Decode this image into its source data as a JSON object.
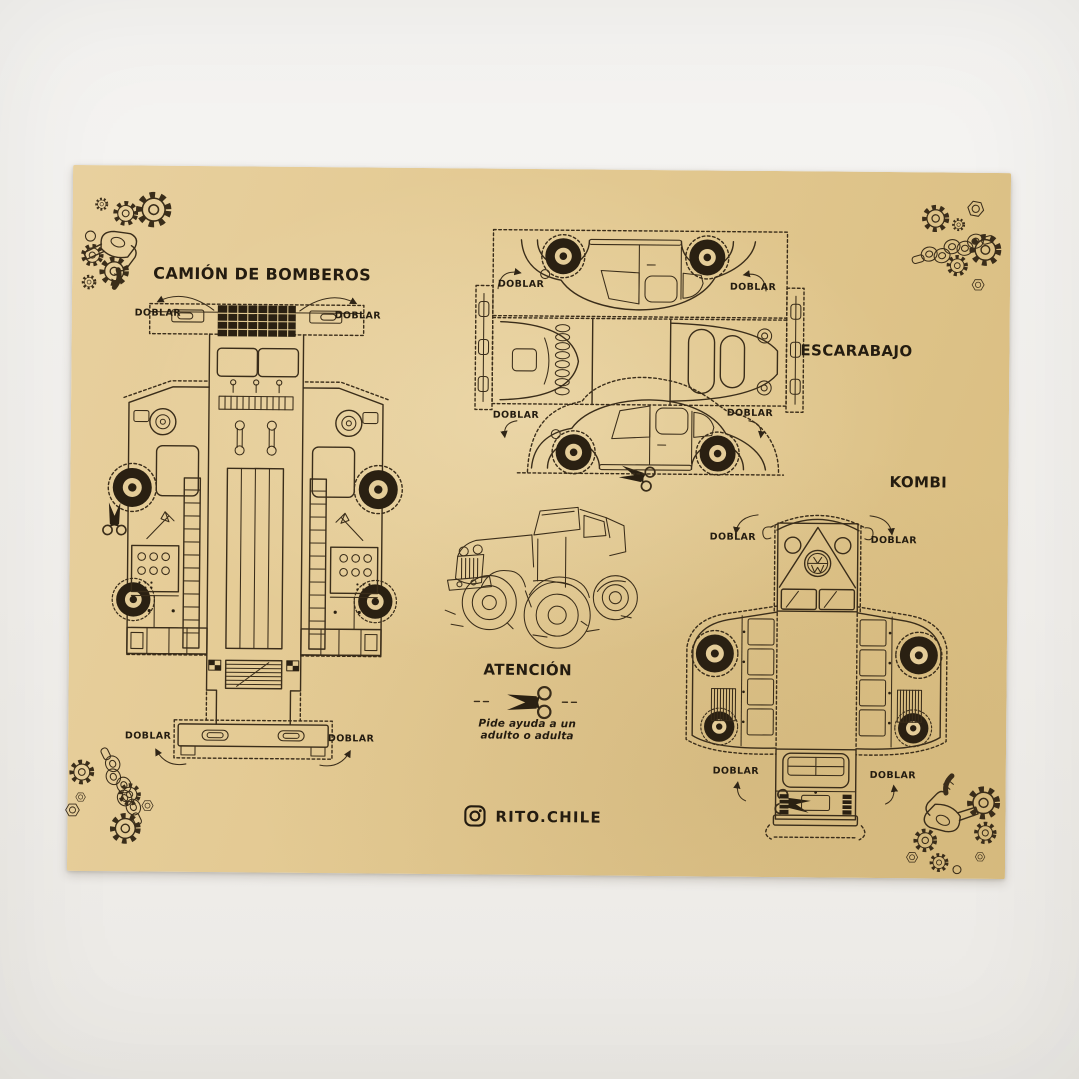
{
  "colors": {
    "background": "#f2f0ed",
    "paper": "#e2c890",
    "ink": "#2f2517"
  },
  "sheet": {
    "titles": {
      "fire_truck": "CAMIÓN DE BOMBEROS",
      "beetle": "ESCARABAJO",
      "kombi": "KOMBI"
    },
    "fold_label": "DOBLAR",
    "attention": {
      "title": "ATENCIÓN",
      "note_line1": "Pide ayuda a un",
      "note_line2": "adulto o adulta"
    },
    "footer": {
      "instagram_handle": "RITO.CHILE"
    },
    "icons": [
      "scissors-icon",
      "gear-icon",
      "hex-nut-icon",
      "crankshaft-icon",
      "fuel-nozzle-icon",
      "instagram-icon",
      "fold-arrow-icon"
    ]
  }
}
